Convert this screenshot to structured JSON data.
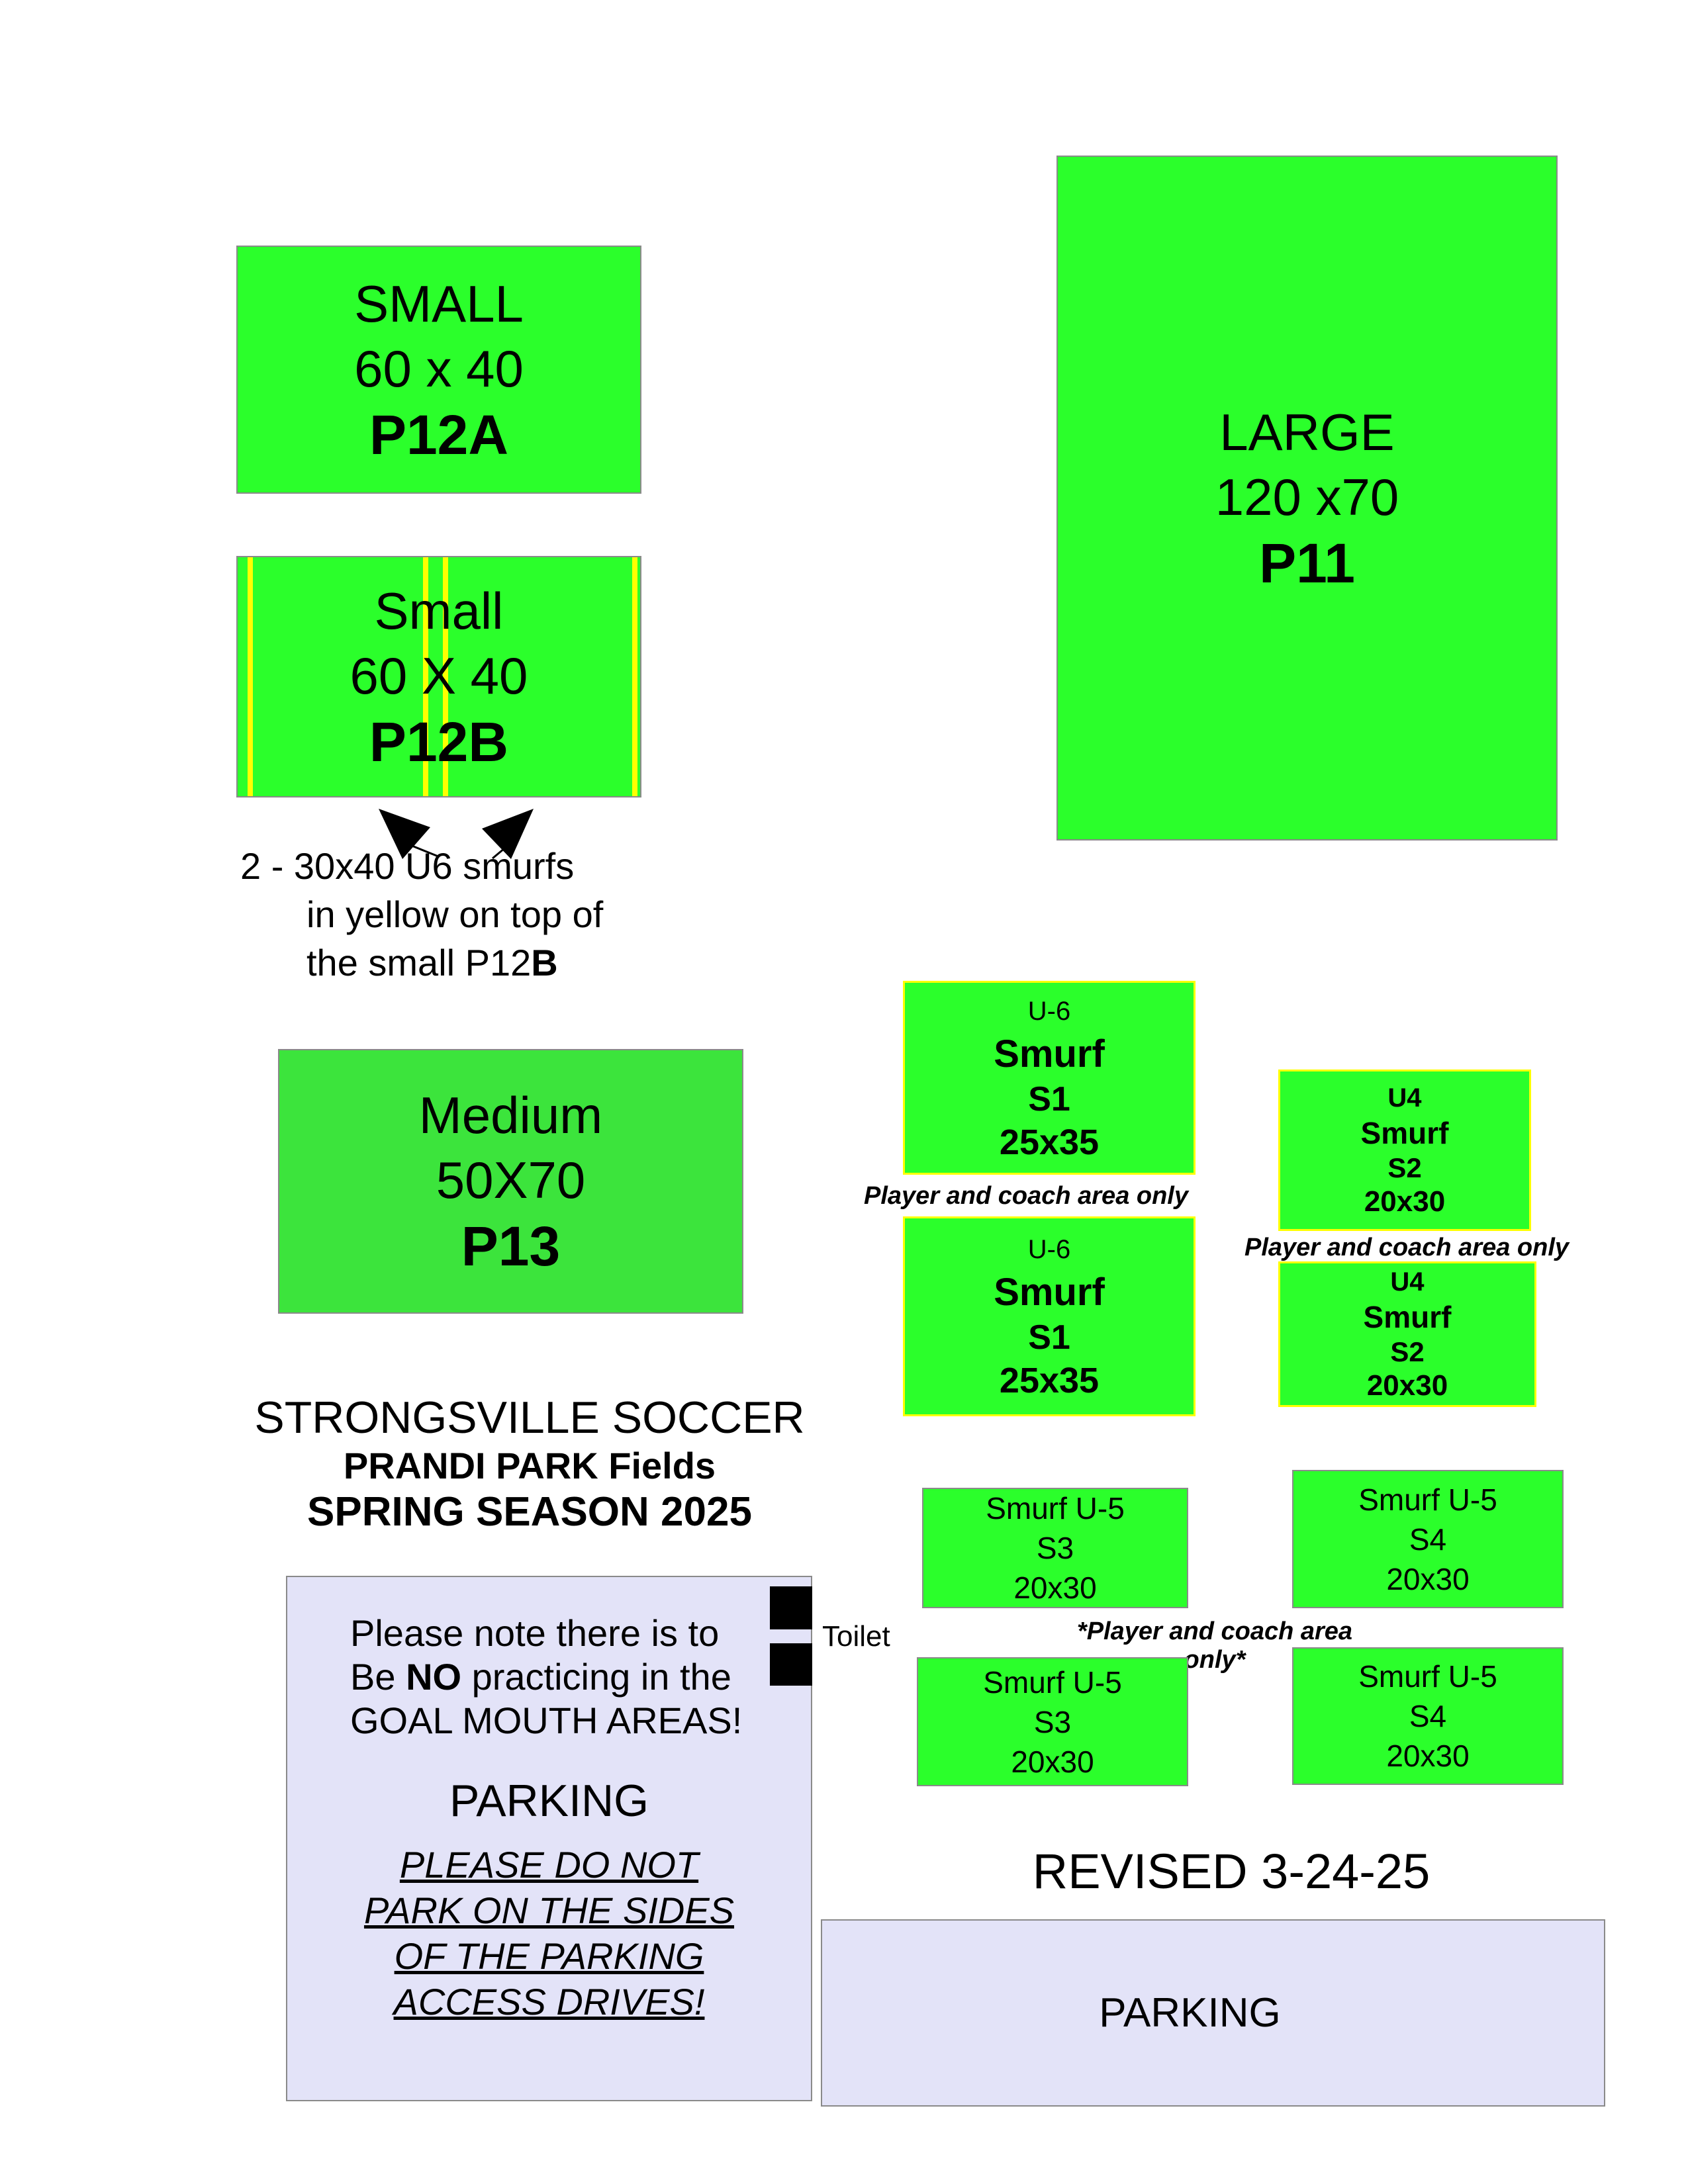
{
  "document": {
    "title_line1": "STRONGSVILLE SOCCER",
    "title_line2": "PRANDI PARK Fields",
    "title_line3": "SPRING SEASON 2025",
    "revised": "REVISED 3-24-25"
  },
  "colors": {
    "bright_green": "#2bff2b",
    "medium_green": "#3ce43c",
    "lavender": "#e3e3f8",
    "line_yellow": "#ffff00",
    "border_gray": "#8a8a8a"
  },
  "fields": {
    "p12a": {
      "name": "SMALL",
      "size": "60 x 40",
      "code": "P12A"
    },
    "p12b": {
      "name": "Small",
      "size": "60 X 40",
      "code": "P12B"
    },
    "p11": {
      "name": "LARGE",
      "size": "120 x70",
      "code": "P11"
    },
    "p13": {
      "name": "Medium",
      "size": "50X70",
      "code": "P13"
    },
    "s1": {
      "age": "U-6",
      "type": "Smurf",
      "code": "S1",
      "size": "25x35"
    },
    "s2": {
      "age": "U4",
      "type": "Smurf",
      "code": "S2",
      "size": "20x30"
    },
    "s3": {
      "name": "Smurf U-5",
      "code": "S3",
      "size": "20x30"
    },
    "s4": {
      "name": "Smurf U-5",
      "code": "S4",
      "size": "20x30"
    }
  },
  "annotations": {
    "smurf_note_line1": "2 - 30x40 U6 smurfs",
    "smurf_note_line2": "in yellow on top of",
    "smurf_note_line3_text": "the small P12",
    "smurf_note_line3_bold": "B",
    "player_coach_s1": "Player and coach area only",
    "player_coach_s2": "Player and coach area only",
    "player_coach_u5": "*Player and coach area only*",
    "toilet": "Toilet"
  },
  "parking_notice": {
    "note_line1": "Please note there is to",
    "note_line2_pre": "Be ",
    "note_line2_bold": "NO",
    "note_line2_post": " practicing in the",
    "note_line3": "GOAL MOUTH AREAS!",
    "heading": "PARKING",
    "warning_lines": [
      "PLEASE DO NOT",
      "PARK ON THE SIDES",
      "OF THE PARKING",
      "ACCESS DRIVES!"
    ]
  },
  "parking_lot_label": "PARKING"
}
